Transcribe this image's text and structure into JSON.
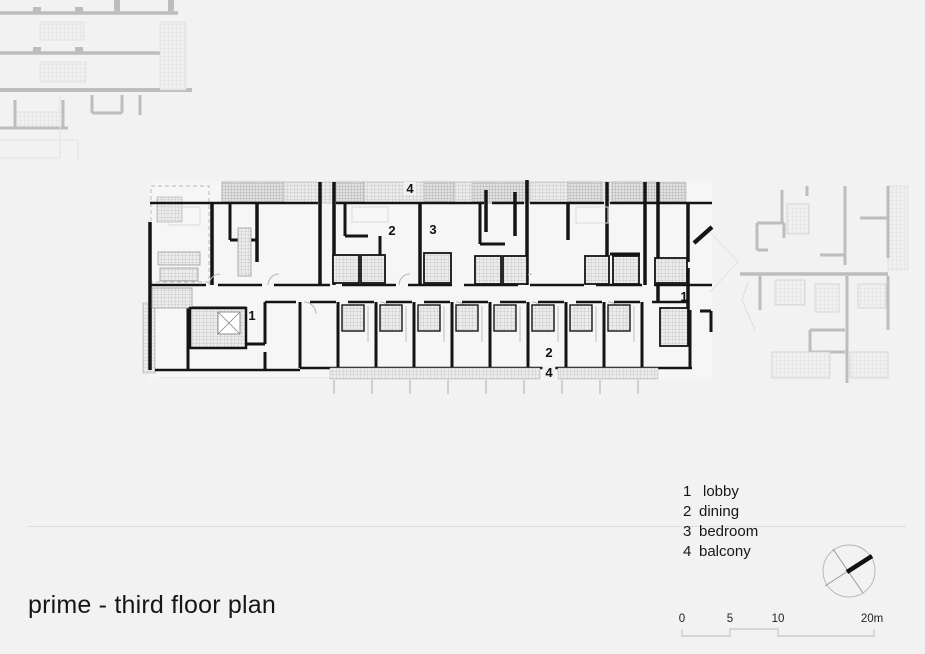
{
  "title": "prime - third floor plan",
  "plan": {
    "labels": {
      "balcony_top": "4",
      "dining_upper": "2",
      "bedroom_upper": "3",
      "lobby_left": "1",
      "lobby_right": "1",
      "dining_lower": "2",
      "balcony_bottom": "4"
    }
  },
  "legend": {
    "items": [
      {
        "num": "1",
        "label": "lobby"
      },
      {
        "num": "2",
        "label": "dining"
      },
      {
        "num": "3",
        "label": "bedroom"
      },
      {
        "num": "4",
        "label": "balcony"
      }
    ]
  },
  "scalebar": {
    "ticks": [
      "0",
      "5",
      "10",
      "20m"
    ]
  },
  "colors": {
    "wall": "#141414",
    "faded_plan": "#bdbdbd",
    "divider": "#dcdcdc",
    "background": "#f2f2f2"
  }
}
